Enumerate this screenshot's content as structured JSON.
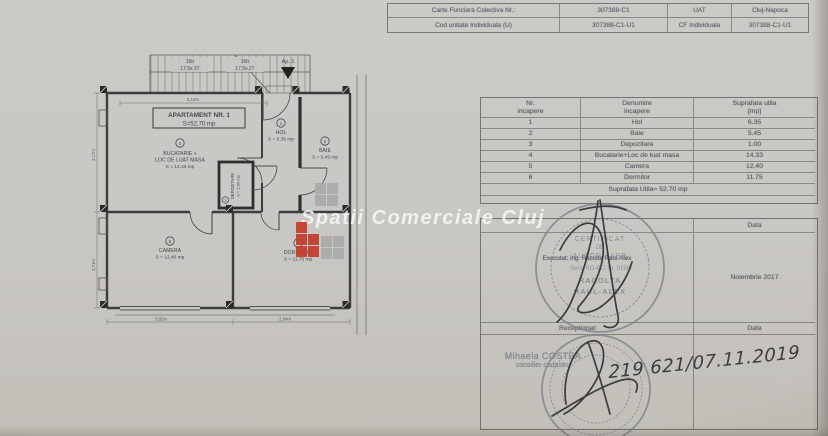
{
  "watermark": {
    "text": "Spatii Comerciale Cluj"
  },
  "cf_table": {
    "rows": [
      {
        "c0": "Carte Funciara Colectiva Nr.:",
        "c1": "307388-C1",
        "c2": "UAT",
        "c3": "Cluj-Napoca"
      },
      {
        "c0": "Cod unitate Individuala (U)",
        "c1": "307388-C1-U1",
        "c2": "CF Individuala",
        "c3": "307388-C1-U1"
      }
    ]
  },
  "plan": {
    "title": "APARTAMENT NR. 1",
    "title_area": "S=52,70 mp",
    "entrance_label": "Ap. 1",
    "stairs": [
      {
        "flight": "16tr",
        "size": "17,5x 27"
      },
      {
        "flight": "16tr",
        "size": "17,5x 27"
      }
    ],
    "rooms": [
      {
        "num": "1",
        "name": "HOL",
        "area": "S = 6,35 mp"
      },
      {
        "num": "2",
        "name": "BAIE",
        "area": "S = 5,45 mp"
      },
      {
        "num": "3",
        "name": "DEPOZITARE",
        "area": "S = 1,00 mp"
      },
      {
        "num": "4",
        "name": "BUCATARIE +",
        "name2": "LOC DE LUAT MASA",
        "area": "S = 14,33 mp"
      },
      {
        "num": "5",
        "name": "CAMERA",
        "area": "S = 12,40 mp"
      },
      {
        "num": "6",
        "name": "DORMITOR",
        "area": "S = 11,75 mp"
      }
    ],
    "dims": {
      "top": "5,10m",
      "left_upper": "3,17m",
      "left_lower": "3,71m",
      "bottom_left": "3,82m",
      "bottom_right": "2,94m"
    }
  },
  "rooms_table": {
    "headers": [
      {
        "l1": "Nr.",
        "l2": "incapere"
      },
      {
        "l1": "Denumire",
        "l2": "incapere"
      },
      {
        "l1": "Suprafata utila",
        "l2": "[mp]"
      }
    ],
    "rows": [
      [
        "1",
        "Hol",
        "6.35"
      ],
      [
        "2",
        "Baie",
        "5.45"
      ],
      [
        "3",
        "Depozitare",
        "1.00"
      ],
      [
        "4",
        "Bucatarie+Loc de luat masa",
        "14.33"
      ],
      [
        "5",
        "Camera",
        "12.40"
      ],
      [
        "6",
        "Dormitor",
        "11.75"
      ]
    ],
    "footer": "Suprafata Utila= 52.70 mp"
  },
  "sign_table": {
    "data_label_top": "Data",
    "executed_by": "Executat: ing. Racolta Raul-Alex",
    "date_value": "Noiembrie 2017",
    "received_label": "Receptionat:",
    "data_label_bottom": "Data",
    "officer_name": "Mihaela COSTEA",
    "officer_title": "consilier cadastru",
    "registration_number": "219 621/07.11.2019"
  },
  "stamp": {
    "l1": "CERTIFICAT",
    "l2": "DE",
    "l3": "AUTORIZARE",
    "l4": "Seria RO-B-J Nr. 0156",
    "l5": "RACOLTA",
    "l6": "RAUL-ALEX"
  },
  "colors": {
    "paper": "#cac8c4",
    "print": "#666a71",
    "line": "#8f8f8b",
    "stamp": "#7e838d",
    "ink": "#313238",
    "logo_red": "#c23b2d",
    "logo_gray": "#a9a9a7",
    "watermark": "#fbfbf9"
  }
}
